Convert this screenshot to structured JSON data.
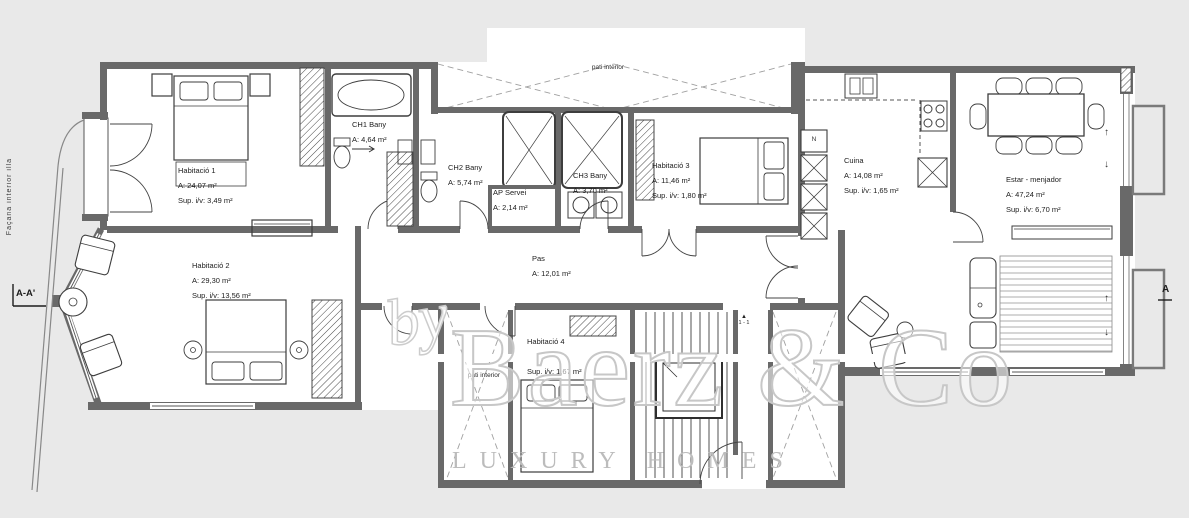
{
  "page": {
    "bg_color": "#e9e9e9",
    "plan_color": "#ffffff",
    "wall_color": "#696969",
    "line_color": "#3d3d3d",
    "dash_color": "#a0a0a0"
  },
  "rooms": [
    {
      "name": "Habitació 1",
      "area": "A: 24,07 m²",
      "sup": "Sup. i/v: 3,49 m²"
    },
    {
      "name": "Habitació 2",
      "area": "A: 29,30 m²",
      "sup": "Sup. i/v: 13,56 m²"
    },
    {
      "name": "Habitació 3",
      "area": "A: 11,46 m²",
      "sup": "Sup. i/v: 1,80 m²"
    },
    {
      "name": "Habitació 4",
      "area": "A: 12,47 m²",
      "sup": "Sup. i/v: 1,67 m²"
    },
    {
      "name": "CH1 Bany",
      "area": "A: 4,64 m²"
    },
    {
      "name": "CH2 Bany",
      "area": "A: 5,74 m²"
    },
    {
      "name": "CH3 Bany",
      "area": "A: 3,70 m²"
    },
    {
      "name": "AP Servei",
      "area": "A: 2,14 m²"
    },
    {
      "name": "Cuina",
      "area": "A: 14,08 m²",
      "sup": "Sup. i/v: 1,65 m²"
    },
    {
      "name": "Estar - menjador",
      "area": "A: 47,24 m²",
      "sup": "Sup. i/v: 6,70 m²"
    },
    {
      "name": "Pas",
      "area": "A: 12,01 m²"
    }
  ],
  "annotations": {
    "facade_label": "Façana interior illa",
    "section_left": "A-A'",
    "section_right": "A",
    "pati_line1": "pati",
    "pati_line2": "interior",
    "stair_triangle": "▲",
    "stair_section": "1 - 1",
    "shaft_n": "N",
    "arrow_up": "↑",
    "arrow_down": "↓"
  },
  "watermark": {
    "barce": "BARCE",
    "by": "by",
    "brand": "Baerz & Co",
    "homes": "LUXURY HOMES"
  }
}
